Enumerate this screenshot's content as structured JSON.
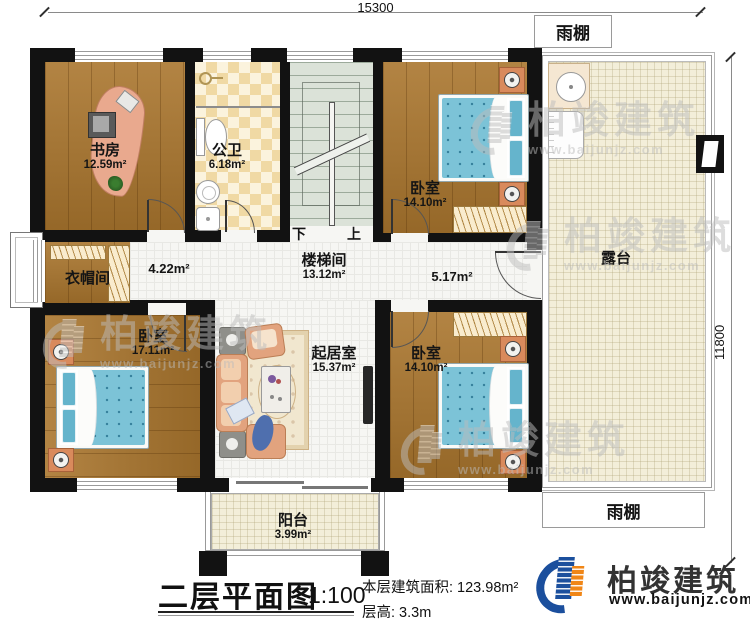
{
  "dimensions": {
    "width_mm": "15300",
    "height_mm": "11800"
  },
  "rooms": {
    "study": {
      "name": "书房",
      "area": "12.59m²"
    },
    "bathroom": {
      "name": "公卫",
      "area": "6.18m²"
    },
    "stairwell": {
      "name": "楼梯间",
      "area": "13.12m²",
      "down_label": "下",
      "up_label": "上"
    },
    "bedroom_ne": {
      "name": "卧室",
      "area": "14.10m²"
    },
    "cloakroom": {
      "name": "衣帽间"
    },
    "hallway_west": {
      "area": "4.22m²"
    },
    "hallway_east": {
      "area": "5.17m²"
    },
    "bedroom_sw": {
      "name": "卧室",
      "area": "17.11m²"
    },
    "living_room": {
      "name": "起居室",
      "area": "15.37m²"
    },
    "bedroom_se": {
      "name": "卧室",
      "area": "14.10m²"
    },
    "terrace": {
      "name": "露台"
    },
    "balcony": {
      "name": "阳台",
      "area": "3.99m²"
    },
    "canopy_top": {
      "name": "雨棚"
    },
    "canopy_bottom": {
      "name": "雨棚"
    }
  },
  "footer": {
    "title": "二层平面图",
    "scale": "1:100",
    "area_label": "本层建筑面积: 123.98m²",
    "floor_height_label": "层高: 3.3m"
  },
  "brand": {
    "name": "柏竣建筑",
    "website": "www.baijunjz.com",
    "blue": "#1b4f9d",
    "orange": "#f08617"
  }
}
